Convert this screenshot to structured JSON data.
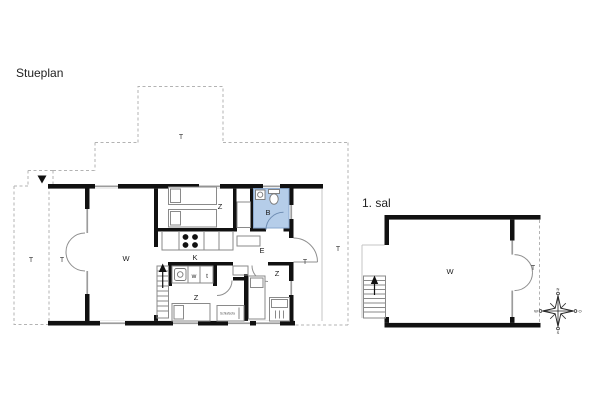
{
  "ground_floor": {
    "title": "Stueplan",
    "labels": {
      "living": "W",
      "kitchen": "K",
      "bathroom": "B",
      "entry": "E",
      "bedroom_top": "Z",
      "bedroom_bottom_left": "Z",
      "bedroom_bottom_right": "Z",
      "washing_machine": "w",
      "dryer": "t",
      "terrace_outer_left": "T",
      "terrace_porch": "T",
      "terrace_top": "T",
      "terrace_door": "T",
      "terrace_right": "T"
    },
    "furniture": {
      "sofa_bed": "Schlafsofa"
    }
  },
  "first_floor": {
    "title": "1. sal",
    "labels": {
      "living": "W",
      "terrace": "T"
    }
  },
  "compass": {
    "north": "N",
    "east": "O",
    "south": "S",
    "west": "W"
  },
  "colors": {
    "wall": "#111111",
    "window": "#9c9c9c",
    "dashed_terrace": "#b3b3b3",
    "bath_fill": "#b5cde9",
    "bath_stroke": "#89a8cf",
    "furniture_stroke": "#8a8a8a",
    "text": "#1b1b1b"
  }
}
